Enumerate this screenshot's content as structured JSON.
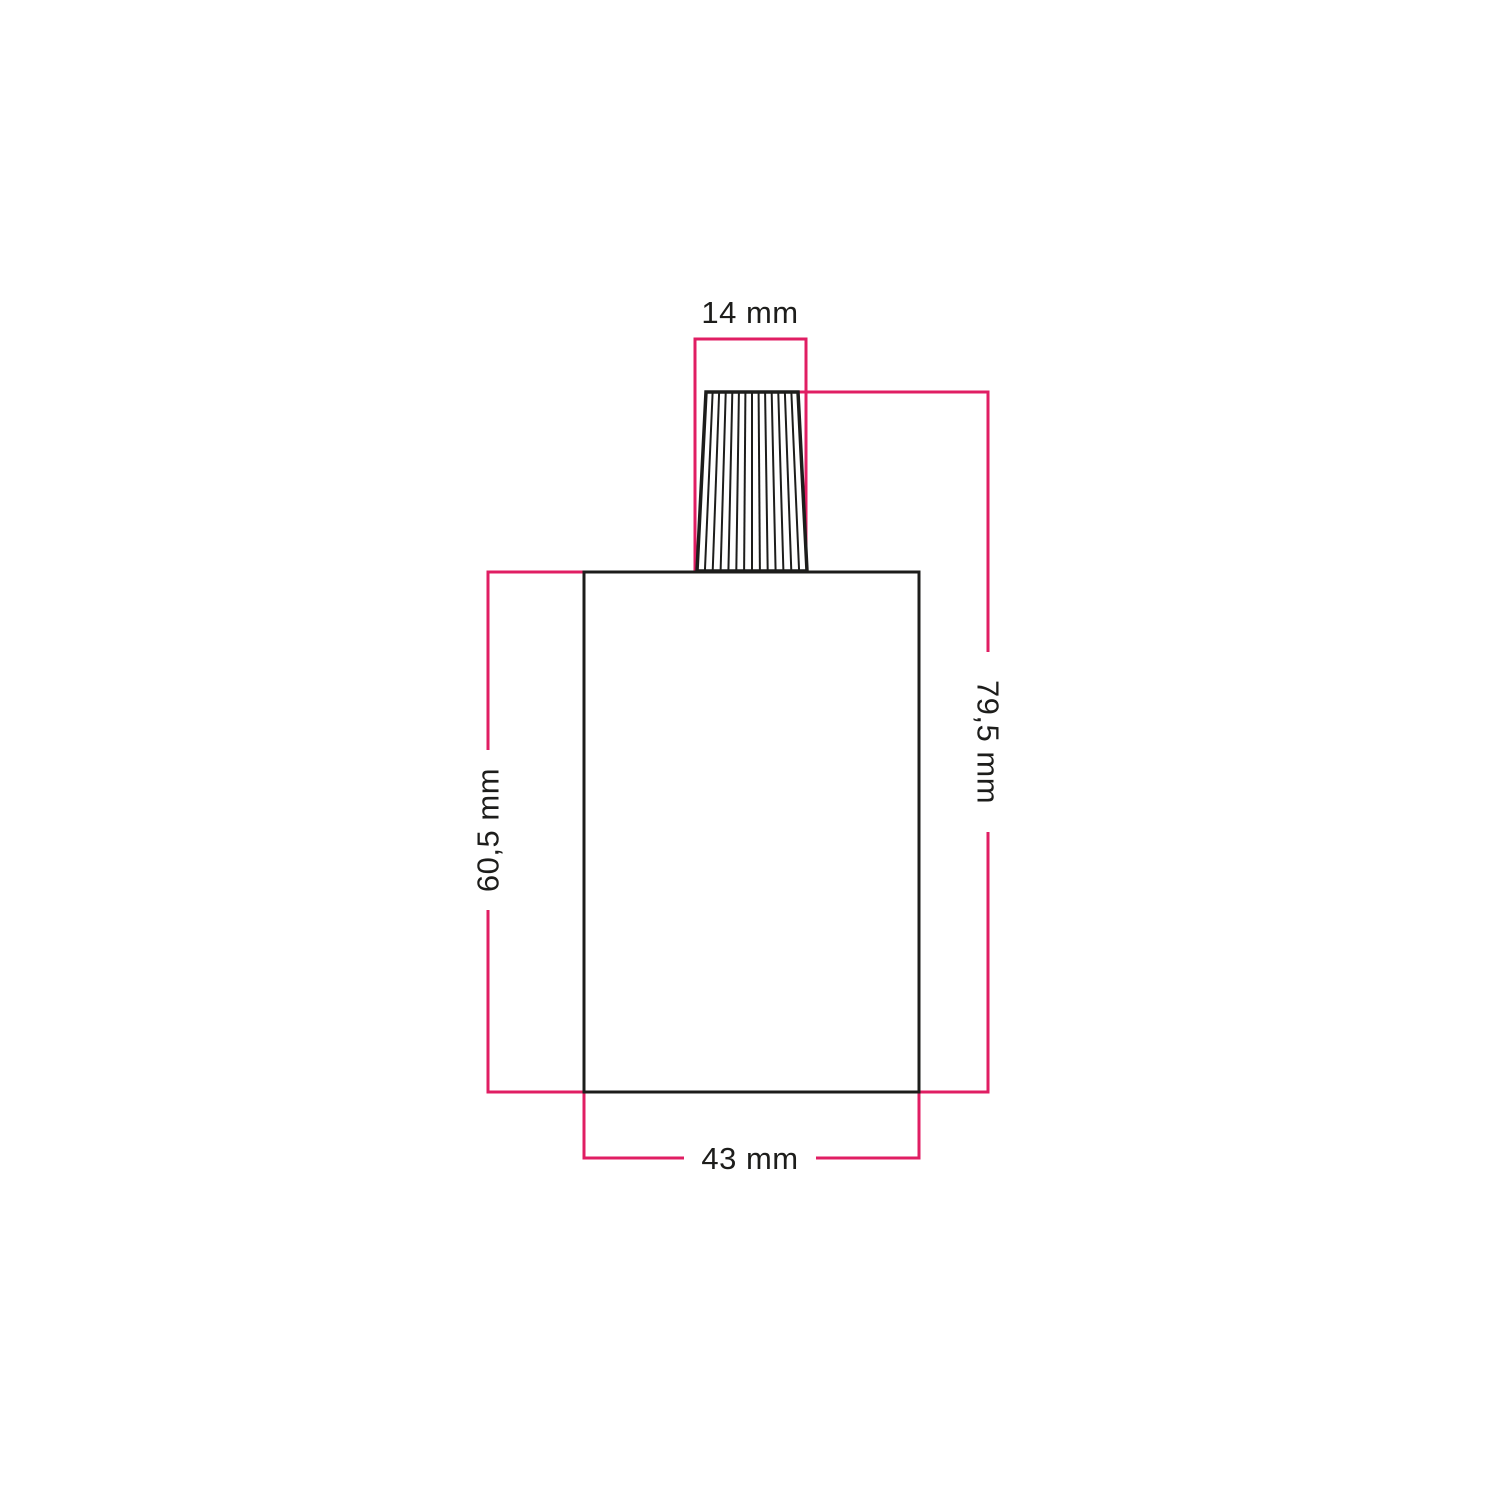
{
  "drawing": {
    "type": "technical-dimension-diagram",
    "labels": {
      "grip_width": "14 mm",
      "total_height": "79,5 mm",
      "body_height": "60,5 mm",
      "body_width": "43 mm"
    }
  },
  "colors": {
    "accent": "#e01e63",
    "ink": "#1d1d1b",
    "background": "#ffffff"
  }
}
